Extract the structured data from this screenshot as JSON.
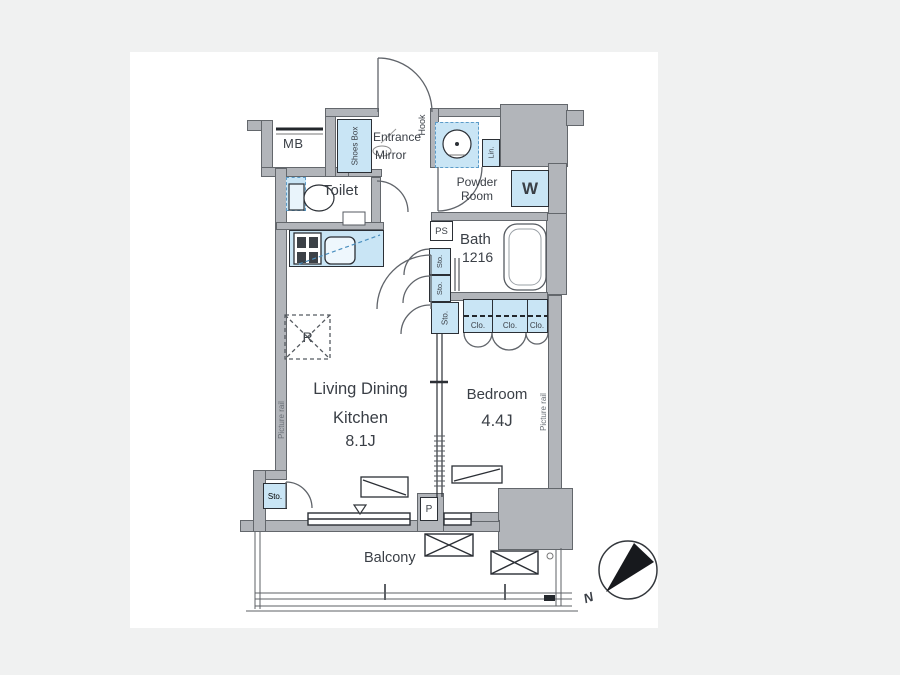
{
  "title": "apartment-floor-plan",
  "labels": {
    "mb": "MB",
    "shoes_box": "Shoes Box",
    "entrance": "Entrance",
    "mirror": "Mirror",
    "hook": "Hook",
    "toilet": "Toilet",
    "powder_line1": "Powder",
    "powder_line2": "Room",
    "linen": "Lin.",
    "washer": "W",
    "ps": "PS",
    "bath": "Bath",
    "bath_size": "1216",
    "sto": "Sto.",
    "clo": "Clo.",
    "living_line1": "Living Dining",
    "living_line2": "Kitchen",
    "living_size": "8.1J",
    "bedroom": "Bedroom",
    "bedroom_size": "4.4J",
    "picture_rail": "Picture rail",
    "refrigerator": "R",
    "pipe": "P",
    "balcony": "Balcony",
    "north": "N"
  },
  "colors": {
    "page_bg": "#f0f1f1",
    "plan_bg": "#ffffff",
    "wall": "#b2b5ba",
    "wall_outline": "#63676c",
    "fixture_blue": "#c9e5f5",
    "line_dark": "#2b2f35",
    "text": "#3a3f46"
  }
}
